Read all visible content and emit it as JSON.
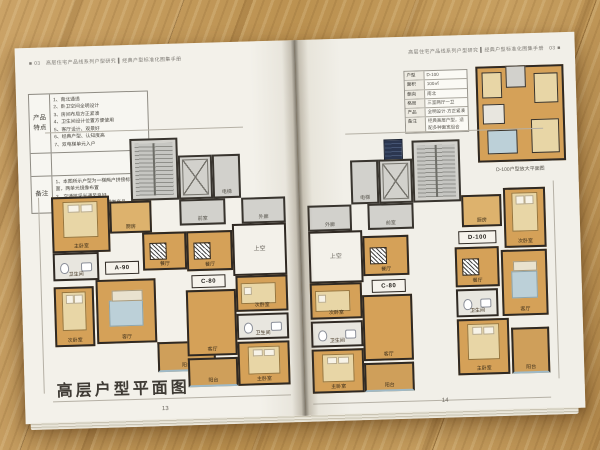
{
  "scene": {
    "description": "photo of an open floor-plan booklet lying on a wooden table"
  },
  "left_page": {
    "header": "■ 03　高层住宅产品线系列户型研究 ▍经典户型标准化图集手册",
    "spec_table": {
      "features_label": "产品特点",
      "features": [
        "1、南北通透",
        "2、卧卫空间全明设计",
        "3、房间布局方正紧凑",
        "4、卫生间设计位置方便使用",
        "5、客厅设计、观景好",
        "6、经典户型、认知度高",
        "7、双电梯单元入户"
      ],
      "notes_label": "备注",
      "notes": [
        "1、本图所示户型为一梯两户拼接标准层平面，两单元镜像布置",
        "2、交通核采光通风良好",
        "3、得房率高，适用于刚需类产品"
      ]
    },
    "plan": {
      "rooms": [
        {
          "x": 84,
          "y": 0,
          "w": 48,
          "h": 62,
          "cls": "core",
          "label": "",
          "furn": "stair"
        },
        {
          "x": 132,
          "y": 18,
          "w": 34,
          "h": 44,
          "cls": "core",
          "label": "",
          "furn": "elev"
        },
        {
          "x": 166,
          "y": 18,
          "w": 28,
          "h": 44,
          "cls": "core",
          "label": "电梯"
        },
        {
          "x": 132,
          "y": 62,
          "w": 46,
          "h": 26,
          "cls": "core",
          "label": "前室"
        },
        {
          "x": 194,
          "y": 62,
          "w": 44,
          "h": 26,
          "cls": "core",
          "label": "外廊"
        },
        {
          "x": 184,
          "y": 88,
          "w": 54,
          "h": 52,
          "cls": "void",
          "label": "上空"
        },
        {
          "x": 4,
          "y": 56,
          "w": 58,
          "h": 56,
          "cls": "room",
          "label": "主卧室",
          "furn": "bed"
        },
        {
          "x": 62,
          "y": 62,
          "w": 42,
          "h": 32,
          "cls": "roomlight",
          "label": "厨房"
        },
        {
          "x": 94,
          "y": 94,
          "w": 44,
          "h": 38,
          "cls": "room",
          "label": "餐厅",
          "furn": "table"
        },
        {
          "x": 4,
          "y": 112,
          "w": 46,
          "h": 28,
          "cls": "bath",
          "label": "卫生间",
          "furn": "wc"
        },
        {
          "x": 46,
          "y": 140,
          "w": 60,
          "h": 64,
          "cls": "room",
          "label": "客厅",
          "furn": "rug"
        },
        {
          "x": 4,
          "y": 146,
          "w": 40,
          "h": 60,
          "cls": "room",
          "label": "次卧室",
          "furn": "bed"
        },
        {
          "x": 106,
          "y": 204,
          "w": 58,
          "h": 30,
          "cls": "balcony",
          "label": "阳台"
        },
        {
          "x": 138,
          "y": 94,
          "w": 46,
          "h": 40,
          "cls": "room",
          "label": "餐厅",
          "furn": "table"
        },
        {
          "x": 186,
          "y": 140,
          "w": 52,
          "h": 36,
          "cls": "room",
          "label": "次卧室",
          "furn": "bed2"
        },
        {
          "x": 186,
          "y": 178,
          "w": 52,
          "h": 26,
          "cls": "bath",
          "label": "卫生间",
          "furn": "wc"
        },
        {
          "x": 186,
          "y": 206,
          "w": 52,
          "h": 44,
          "cls": "room",
          "label": "主卧室",
          "furn": "bed"
        },
        {
          "x": 136,
          "y": 153,
          "w": 50,
          "h": 66,
          "cls": "room",
          "label": "客厅"
        },
        {
          "x": 136,
          "y": 221,
          "w": 50,
          "h": 29,
          "cls": "balcony",
          "label": "阳台"
        },
        {
          "x": 56,
          "y": 122,
          "w": 34,
          "h": 13,
          "cls": "tag",
          "label": "A-90"
        },
        {
          "x": 142,
          "y": 138,
          "w": 34,
          "h": 13,
          "cls": "tag",
          "label": "C-80"
        }
      ]
    },
    "title": "高层户型平面图",
    "page_number": "13"
  },
  "right_page": {
    "header": "高层住宅产品线系列户型研究 ▍经典户型标准化图集手册　03 ■",
    "inset": {
      "table_rows": [
        [
          "户型",
          "D-100"
        ],
        [
          "面积",
          "100㎡"
        ],
        [
          "朝向",
          "南北"
        ],
        [
          "格局",
          "三室两厅一卫"
        ],
        [
          "产品",
          "全明设计·方正紧凑"
        ],
        [
          "备注",
          "经典高层户型，适配多种面宽组合"
        ]
      ],
      "caption": "D-100户型放大平面图"
    },
    "plan": {
      "rooms": [
        {
          "x": 106,
          "y": 0,
          "w": 48,
          "h": 62,
          "cls": "core",
          "label": "",
          "furn": "stair"
        },
        {
          "x": 72,
          "y": 18,
          "w": 34,
          "h": 44,
          "cls": "core",
          "label": "",
          "furn": "elev"
        },
        {
          "x": 44,
          "y": 18,
          "w": 28,
          "h": 44,
          "cls": "core",
          "label": "电梯"
        },
        {
          "x": 60,
          "y": 62,
          "w": 46,
          "h": 26,
          "cls": "core",
          "label": "前室"
        },
        {
          "x": 0,
          "y": 62,
          "w": 44,
          "h": 26,
          "cls": "core",
          "label": "外廊"
        },
        {
          "x": 0,
          "y": 88,
          "w": 54,
          "h": 52,
          "cls": "void",
          "label": "上空"
        },
        {
          "x": 54,
          "y": 94,
          "w": 46,
          "h": 40,
          "cls": "room",
          "label": "餐厅",
          "furn": "table"
        },
        {
          "x": 0,
          "y": 140,
          "w": 52,
          "h": 36,
          "cls": "room",
          "label": "次卧室",
          "furn": "bed2"
        },
        {
          "x": 0,
          "y": 178,
          "w": 52,
          "h": 26,
          "cls": "bath",
          "label": "卫生间",
          "furn": "wc"
        },
        {
          "x": 0,
          "y": 206,
          "w": 52,
          "h": 44,
          "cls": "room",
          "label": "主卧室",
          "furn": "bed"
        },
        {
          "x": 52,
          "y": 153,
          "w": 50,
          "h": 66,
          "cls": "room",
          "label": "客厅"
        },
        {
          "x": 52,
          "y": 221,
          "w": 50,
          "h": 29,
          "cls": "balcony",
          "label": "阳台"
        },
        {
          "x": 154,
          "y": 56,
          "w": 40,
          "h": 32,
          "cls": "roomlight",
          "label": "厨房"
        },
        {
          "x": 196,
          "y": 50,
          "w": 42,
          "h": 60,
          "cls": "room",
          "label": "次卧室",
          "furn": "bed"
        },
        {
          "x": 146,
          "y": 108,
          "w": 44,
          "h": 40,
          "cls": "room",
          "label": "餐厅",
          "furn": "table"
        },
        {
          "x": 192,
          "y": 112,
          "w": 46,
          "h": 66,
          "cls": "room",
          "label": "客厅",
          "furn": "rug"
        },
        {
          "x": 146,
          "y": 150,
          "w": 42,
          "h": 28,
          "cls": "bath",
          "label": "卫生间",
          "furn": "wc"
        },
        {
          "x": 146,
          "y": 180,
          "w": 52,
          "h": 56,
          "cls": "room",
          "label": "主卧室",
          "furn": "bed"
        },
        {
          "x": 200,
          "y": 190,
          "w": 38,
          "h": 46,
          "cls": "balcony",
          "label": "阳台"
        },
        {
          "x": 62,
          "y": 138,
          "w": 34,
          "h": 13,
          "cls": "tag",
          "label": "C-80"
        },
        {
          "x": 150,
          "y": 92,
          "w": 38,
          "h": 13,
          "cls": "tag",
          "label": "D-100"
        }
      ]
    },
    "page_number": "14"
  }
}
